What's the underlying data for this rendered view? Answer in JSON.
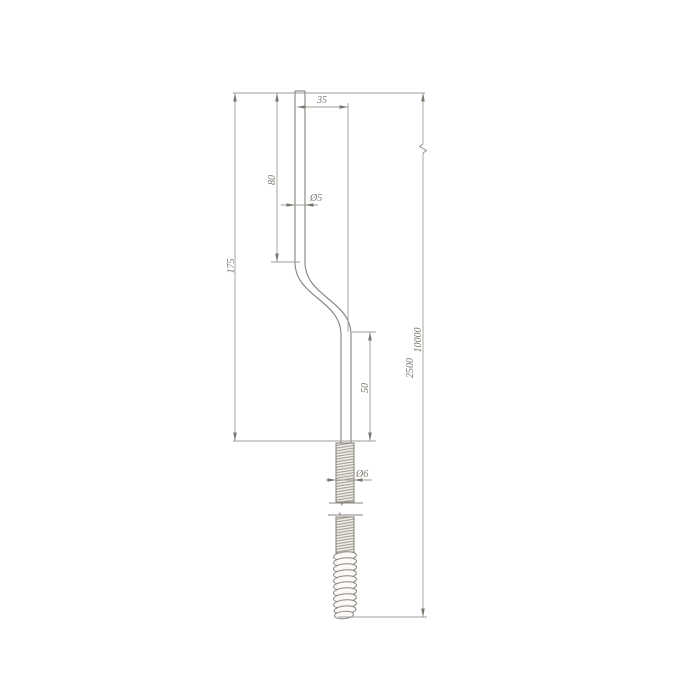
{
  "drawing": {
    "title": "offset-rod-with-threaded-end-technical-drawing",
    "dimensions": {
      "offset_width": "35",
      "upper_segment_length": "80",
      "rod_diameter": "Ø5",
      "upper_total_length": "175",
      "lower_segment_length": "50",
      "thread_diameter": "Ø6",
      "length_option_short": "2500",
      "length_option_long": "10000"
    },
    "colors": {
      "line": "#8a8680",
      "dim": "#a29d97",
      "text": "#7b766f",
      "hatch": "#968f86",
      "fill": "#efede9"
    }
  }
}
